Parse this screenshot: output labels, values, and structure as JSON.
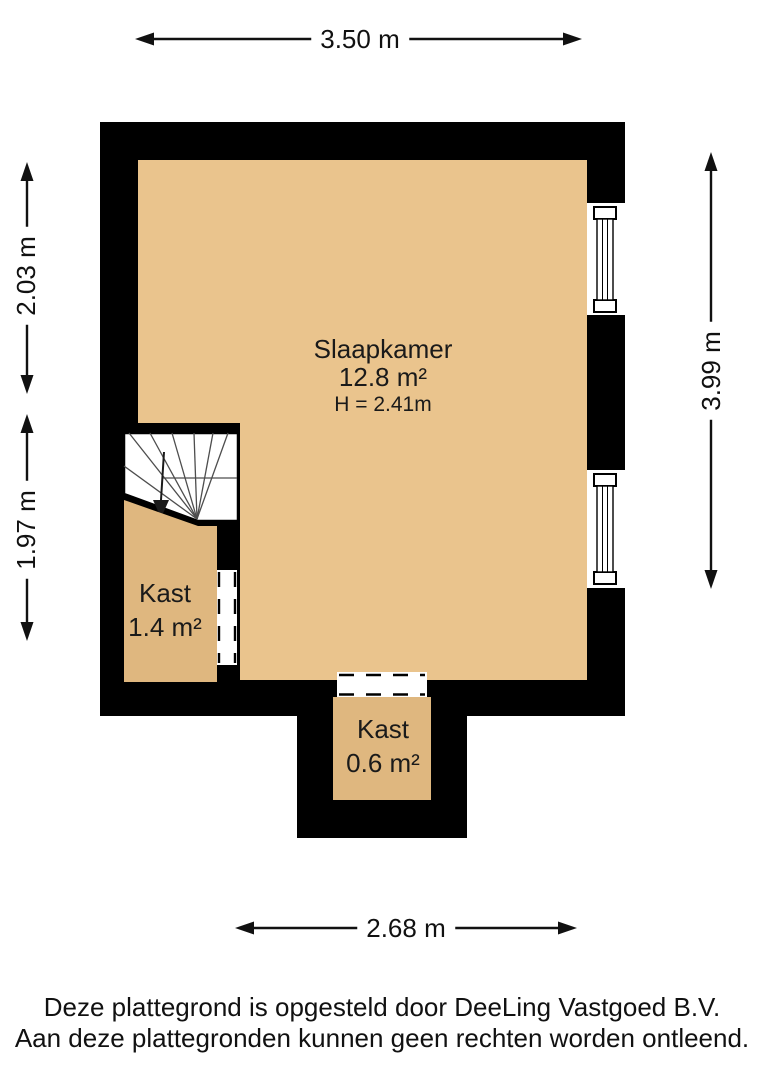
{
  "floorplan": {
    "rooms": {
      "slaapkamer": {
        "name": "Slaapkamer",
        "area": "12.8 m²",
        "ceiling_height": "H = 2.41m"
      },
      "kast_left": {
        "name": "Kast",
        "area": "1.4 m²"
      },
      "kast_bottom": {
        "name": "Kast",
        "area": "0.6 m²"
      }
    },
    "dimensions": {
      "top": "3.50 m",
      "left_upper": "2.03 m",
      "left_lower": "1.97 m",
      "right": "3.99 m",
      "bottom": "2.68 m"
    },
    "colors": {
      "wall": "#000000",
      "floor_main": "#EAC48D",
      "floor_closet": "#DFB77F",
      "stair_fill": "#FFFFFF",
      "opening_fill": "#FFFFFF",
      "line": "#111111"
    }
  },
  "footer": {
    "line1": "Deze plattegrond is opgesteld door DeeLing Vastgoed B.V.",
    "line2": "Aan deze plattegronden kunnen geen rechten worden ontleend."
  }
}
